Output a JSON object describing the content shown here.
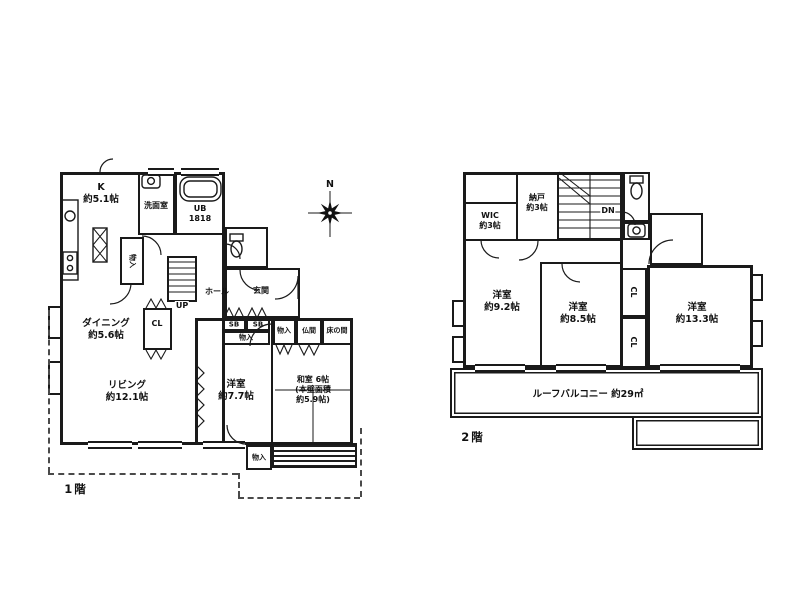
{
  "palette": {
    "ink": "#1a1a1a",
    "paper": "#ffffff"
  },
  "compass": {
    "label": "N"
  },
  "floor1": {
    "title": "1階",
    "rooms": {
      "kitchen": "K\n約5.1帖",
      "washroom": "洗面室",
      "bath": "UB\n1818",
      "storage_stair": "物入",
      "hall": "ホール",
      "stairs_up": "UP",
      "entrance": "玄関",
      "shoe_box_left": "SB",
      "shoe_box_right": "SB",
      "storage_entrance": "物入",
      "dining": "ダイニング\n約5.6帖",
      "closet": "CL",
      "living": "リビング\n約12.1帖",
      "western_room": "洋室\n約7.7帖",
      "japanese_room": "和室 6帖\n(本壁面積\n約5.9帖)",
      "storage_washitsu": "物入",
      "butsuma": "仏間",
      "tokonoma": "床の間",
      "storage_south": "物入"
    }
  },
  "floor2": {
    "title": "2階",
    "rooms": {
      "wic": "WIC\n約3帖",
      "nando": "納戸\n約3帖",
      "stairs_down": "DN",
      "bedroom_west": "洋室\n約9.2帖",
      "bedroom_center": "洋室\n約8.5帖",
      "bedroom_east": "洋室\n約13.3帖",
      "closet_upper": "CL",
      "closet_lower": "CL",
      "roof_balcony": "ルーフバルコニー 約29㎡"
    }
  }
}
